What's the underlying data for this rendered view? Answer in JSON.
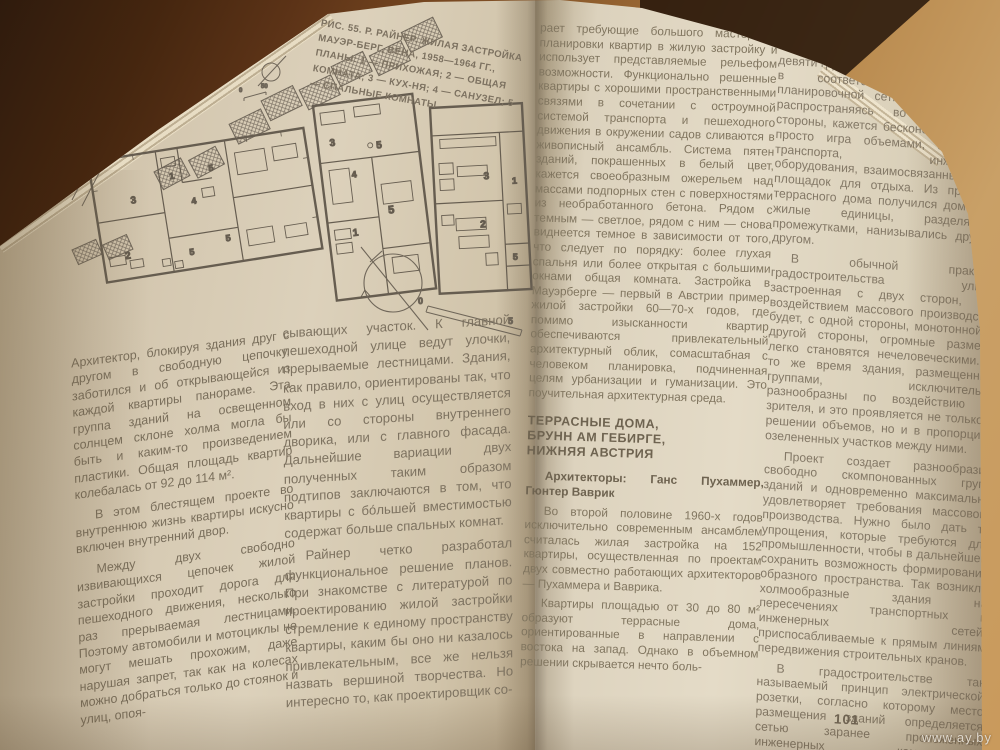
{
  "figure": {
    "caption": "РИС. 55. Р. РАЙНЕР. ЖИЛАЯ ЗАСТРОЙКА МАУЭР-БЕРГ, ВЕНА, 1958—1964 ГГ., ПЛАНЫ: 1 — ПРИХОЖАЯ; 2 — ОБЩАЯ КОМНАТА; 3 — КУХ-НЯ; 4 — САНУЗЕЛ; 5 — СПАЛЬНЫЕ КОМНАТЫ",
    "site_scale": [
      "0",
      "50"
    ],
    "plan_scale": [
      "0",
      "5"
    ],
    "plan_a_rooms": [
      "3",
      "1",
      "4",
      "5",
      "2",
      "5",
      "5"
    ],
    "plan_b_rooms": [
      "3",
      "4",
      "5",
      "5",
      "1"
    ],
    "plan_c_rooms": [
      "3",
      "2",
      "1",
      "5"
    ]
  },
  "left_page": {
    "column1": [
      "Архитектор, блокируя здания друг с другом в свободную цепочку, заботился и об открывающейся из каждой квартиры панораме. Эта группа зданий на освещенном солнцем склоне холма могла бы быть и каким-то произведением пластики. Общая площадь квартир колебалась от 92 до 114 м².",
      "В этом блестящем проекте во внутреннюю жизнь квартиры искусно включен внутренний двор.",
      "Между двух свободно извивающихся цепочек жилой застройки проходит дорога для пешеходного движения, несколько раз прерываемая лестницами. Поэтому автомобили и мотоциклы не могут мешать прохожим, даже нарушая запрет, так как на колесах можно добраться только до стоянок и улиц, опоя-"
    ],
    "column2": [
      "сывающих участок. К главной пешеходной улице ведут улочки, прерываемые лестницами. Здания, как правило, ориентированы так, что вход в них с улиц осуществляется или со стороны внутреннего дворика, или с главного фасада. Дальнейшие вариации двух полученных таким образом подтипов заключаются в том, что квартиры с бо́льшей вместимостью содержат больше спальных комнат.",
      "Райнер четко разработал функциональное решение планов. При знакомстве с литературой по проектированию жилой застройки стремление к единому пространству квартиры, каким бы оно ни казалось привлекательным, все же нельзя назвать вершиной творчества. Но интересно то, как проектировщик со-"
    ]
  },
  "right_page": {
    "column1_intro": "рает требующие большого мастерства планировки квартир в жилую застройку и использует представляемые рельефом возможности. Функционально решенные квартиры с хорошими пространственными связями в сочетании с остроумной системой транспорта и пешеходного движения в окружении садов сливаются в живописный ансамбль. Система пятен зданий, покрашенных в белый цвет, кажется своеобразным ожерельем над массами подпорных стен с поверхностями из необработанного бетона. Рядом с темным — светлое, рядом с ним — снова виднеется темное в зависимости от того, что следует по порядку: более глухая спальня или более открытая с большими окнами общая комната. Застройка в Мауэрберге — первый в Австрии пример жилой застройки 60—70-х годов, где помимо изысканности квартир обеспечиваются привлекательный архитектурный облик, сомасштабная с человеком планировка, подчиненная целям урбанизации и гуманизации. Это поучительная архитектурная среда.",
    "section_heading": "ТЕРРАСНЫЕ ДОМА,\nБРУНН АМ ГЕБИРГЕ,\nНИЖНЯЯ АВСТРИЯ",
    "architects": "Архитекторы: Ганс Пухаммер, Гюнтер Ваврик",
    "column1_rest": [
      "Во второй половине 1960-х годов исключительно современным ансамблем считалась жилая застройка на 152 квартиры, осуществленная по проектам двух совместно работающих архитекторов — Пухаммера и Ваврика.",
      "Квартиры площадью от 30 до 80 м² образуют террасные дома, ориентированные в направлении с востока на запад. Однако в объемном решении скрывается нечто боль-"
    ],
    "column2": [
      "шее. Ведь застройка, состоящая из девяти групп зданий, была разработана в соответствии с единой планировочной сеткой, и эта сетка, распространяясь во все четыре стороны, кажется бесконечной. Это не просто игра объемами, а система транспорта, инженерного оборудования, взаимосвязанные пятна площадок для отдыха. Из принципа террасного дома получился дом-холм; жилые единицы, разделяемые промежутками, нанизывались друг за другом.",
      "В обычной практике градостроительства улица, застроенная с двух сторон, под воздействием массового производства будет, с одной стороны, монотонной; с другой стороны, огромные размеры легко становятся нечеловеческими. В то же время здания, размещенные группами, исключительно разнообразны по воздействию на зрителя, и это проявляется не только в решении объемов, но и в пропорциях озелененных участков между ними.",
      "Проект создает разнообразие свободно скомпонованных групп зданий и одновременно максимально удовлетворяет требования массового производства. Нужно было дать те упрощения, которые требуются для промышленности, чтобы в дальнейшем сохранить возможность формирования образного пространства. Так возникли холмообразные здания на пересечениях транспортных и инженерных сетей, приспосабливаемые к прямым линиям передвижения строительных кранов.",
      "В градостроительстве так называемый принцип электрической розетки, согласно которому место размещения зданий определяется сетью заранее проложенных инженерных коммуникаций; инженерные коммуни-"
    ],
    "page_number": "101"
  },
  "photo": {
    "watermark": "www.ay.by"
  }
}
